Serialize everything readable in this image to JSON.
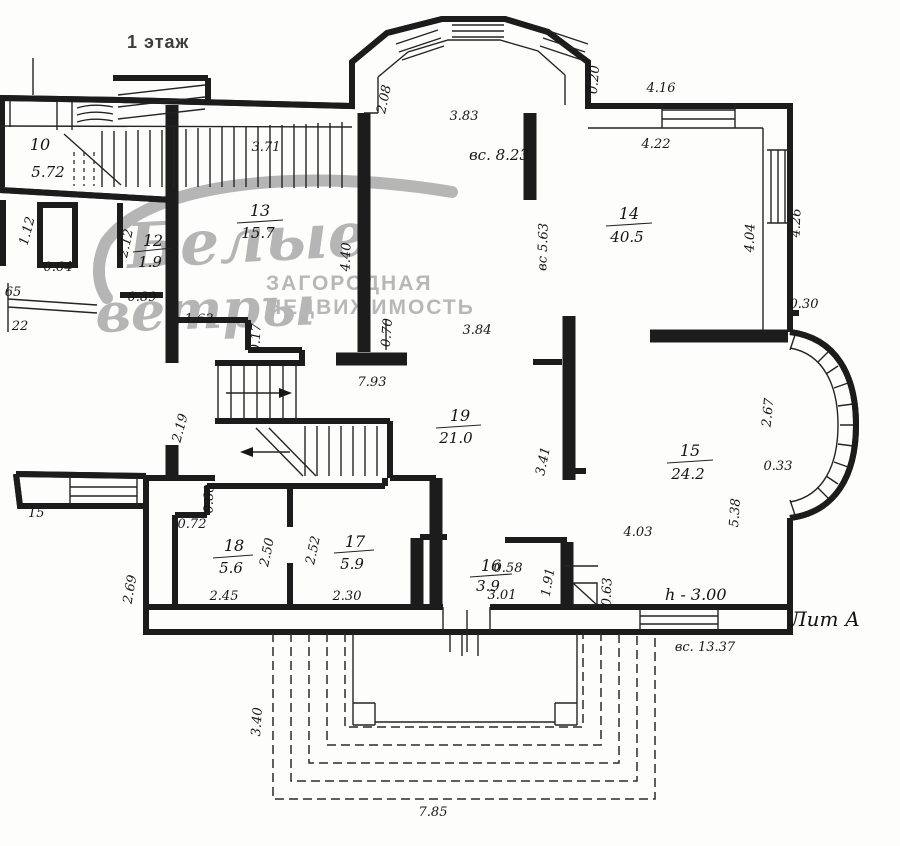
{
  "title": "1 этаж",
  "watermark": {
    "word1": "Белые",
    "word2": "ветры",
    "caption1": "ЗАГОРОДНАЯ",
    "caption2": "НЕДВИЖИМОСТЬ",
    "color": "#9a9a9a"
  },
  "annotations": {
    "height_mark": "h - 3.00",
    "litera": "Лит А",
    "bottom_span": "вс. 13.37",
    "balcony_label": "15"
  },
  "rooms": {
    "r10": {
      "num": "10",
      "area": "5.72"
    },
    "r12": {
      "num": "12",
      "area": "1.9"
    },
    "r13": {
      "num": "13",
      "area": "15.7"
    },
    "r14": {
      "num": "14",
      "area": "40.5"
    },
    "r15": {
      "num": "15",
      "area": "24.2"
    },
    "r16": {
      "num": "16",
      "area": "3.9"
    },
    "r17": {
      "num": "17",
      "area": "5.9"
    },
    "r18": {
      "num": "18",
      "area": "5.6"
    },
    "r19": {
      "num": "19",
      "area": "21.0"
    }
  },
  "dims": {
    "v371": "3.71",
    "v208": "2.08",
    "v383": "3.83",
    "v823": "вс. 8.23",
    "v020": "0.20",
    "v416": "4.16",
    "v422": "4.22",
    "v404": "4.04",
    "v426": "4.26",
    "v112": "1.12",
    "v064": "0.64",
    "v212": "2.12",
    "v65": "65",
    "v22": "22",
    "v440": "4.40",
    "v563": "вс 5.63",
    "v089": "0.89",
    "v163": "1.63",
    "v017": "0.17",
    "v070": "0.70",
    "v793": "7.93",
    "v384": "3.84",
    "v219": "2.19",
    "v267": "2.67",
    "v030": "0.30",
    "v033": "0.33",
    "v538": "5.38",
    "v341": "3.41",
    "v403": "4.03",
    "v269": "2.69",
    "v060": "0.60",
    "v072": "0.72",
    "v250": "2.50",
    "v252": "2.52",
    "v245": "2.45",
    "v230": "2.30",
    "v301": "3.01",
    "v191": "1.91",
    "v058": "0.58",
    "v063": "0.63",
    "v340": "3.40",
    "v785": "7.85"
  }
}
